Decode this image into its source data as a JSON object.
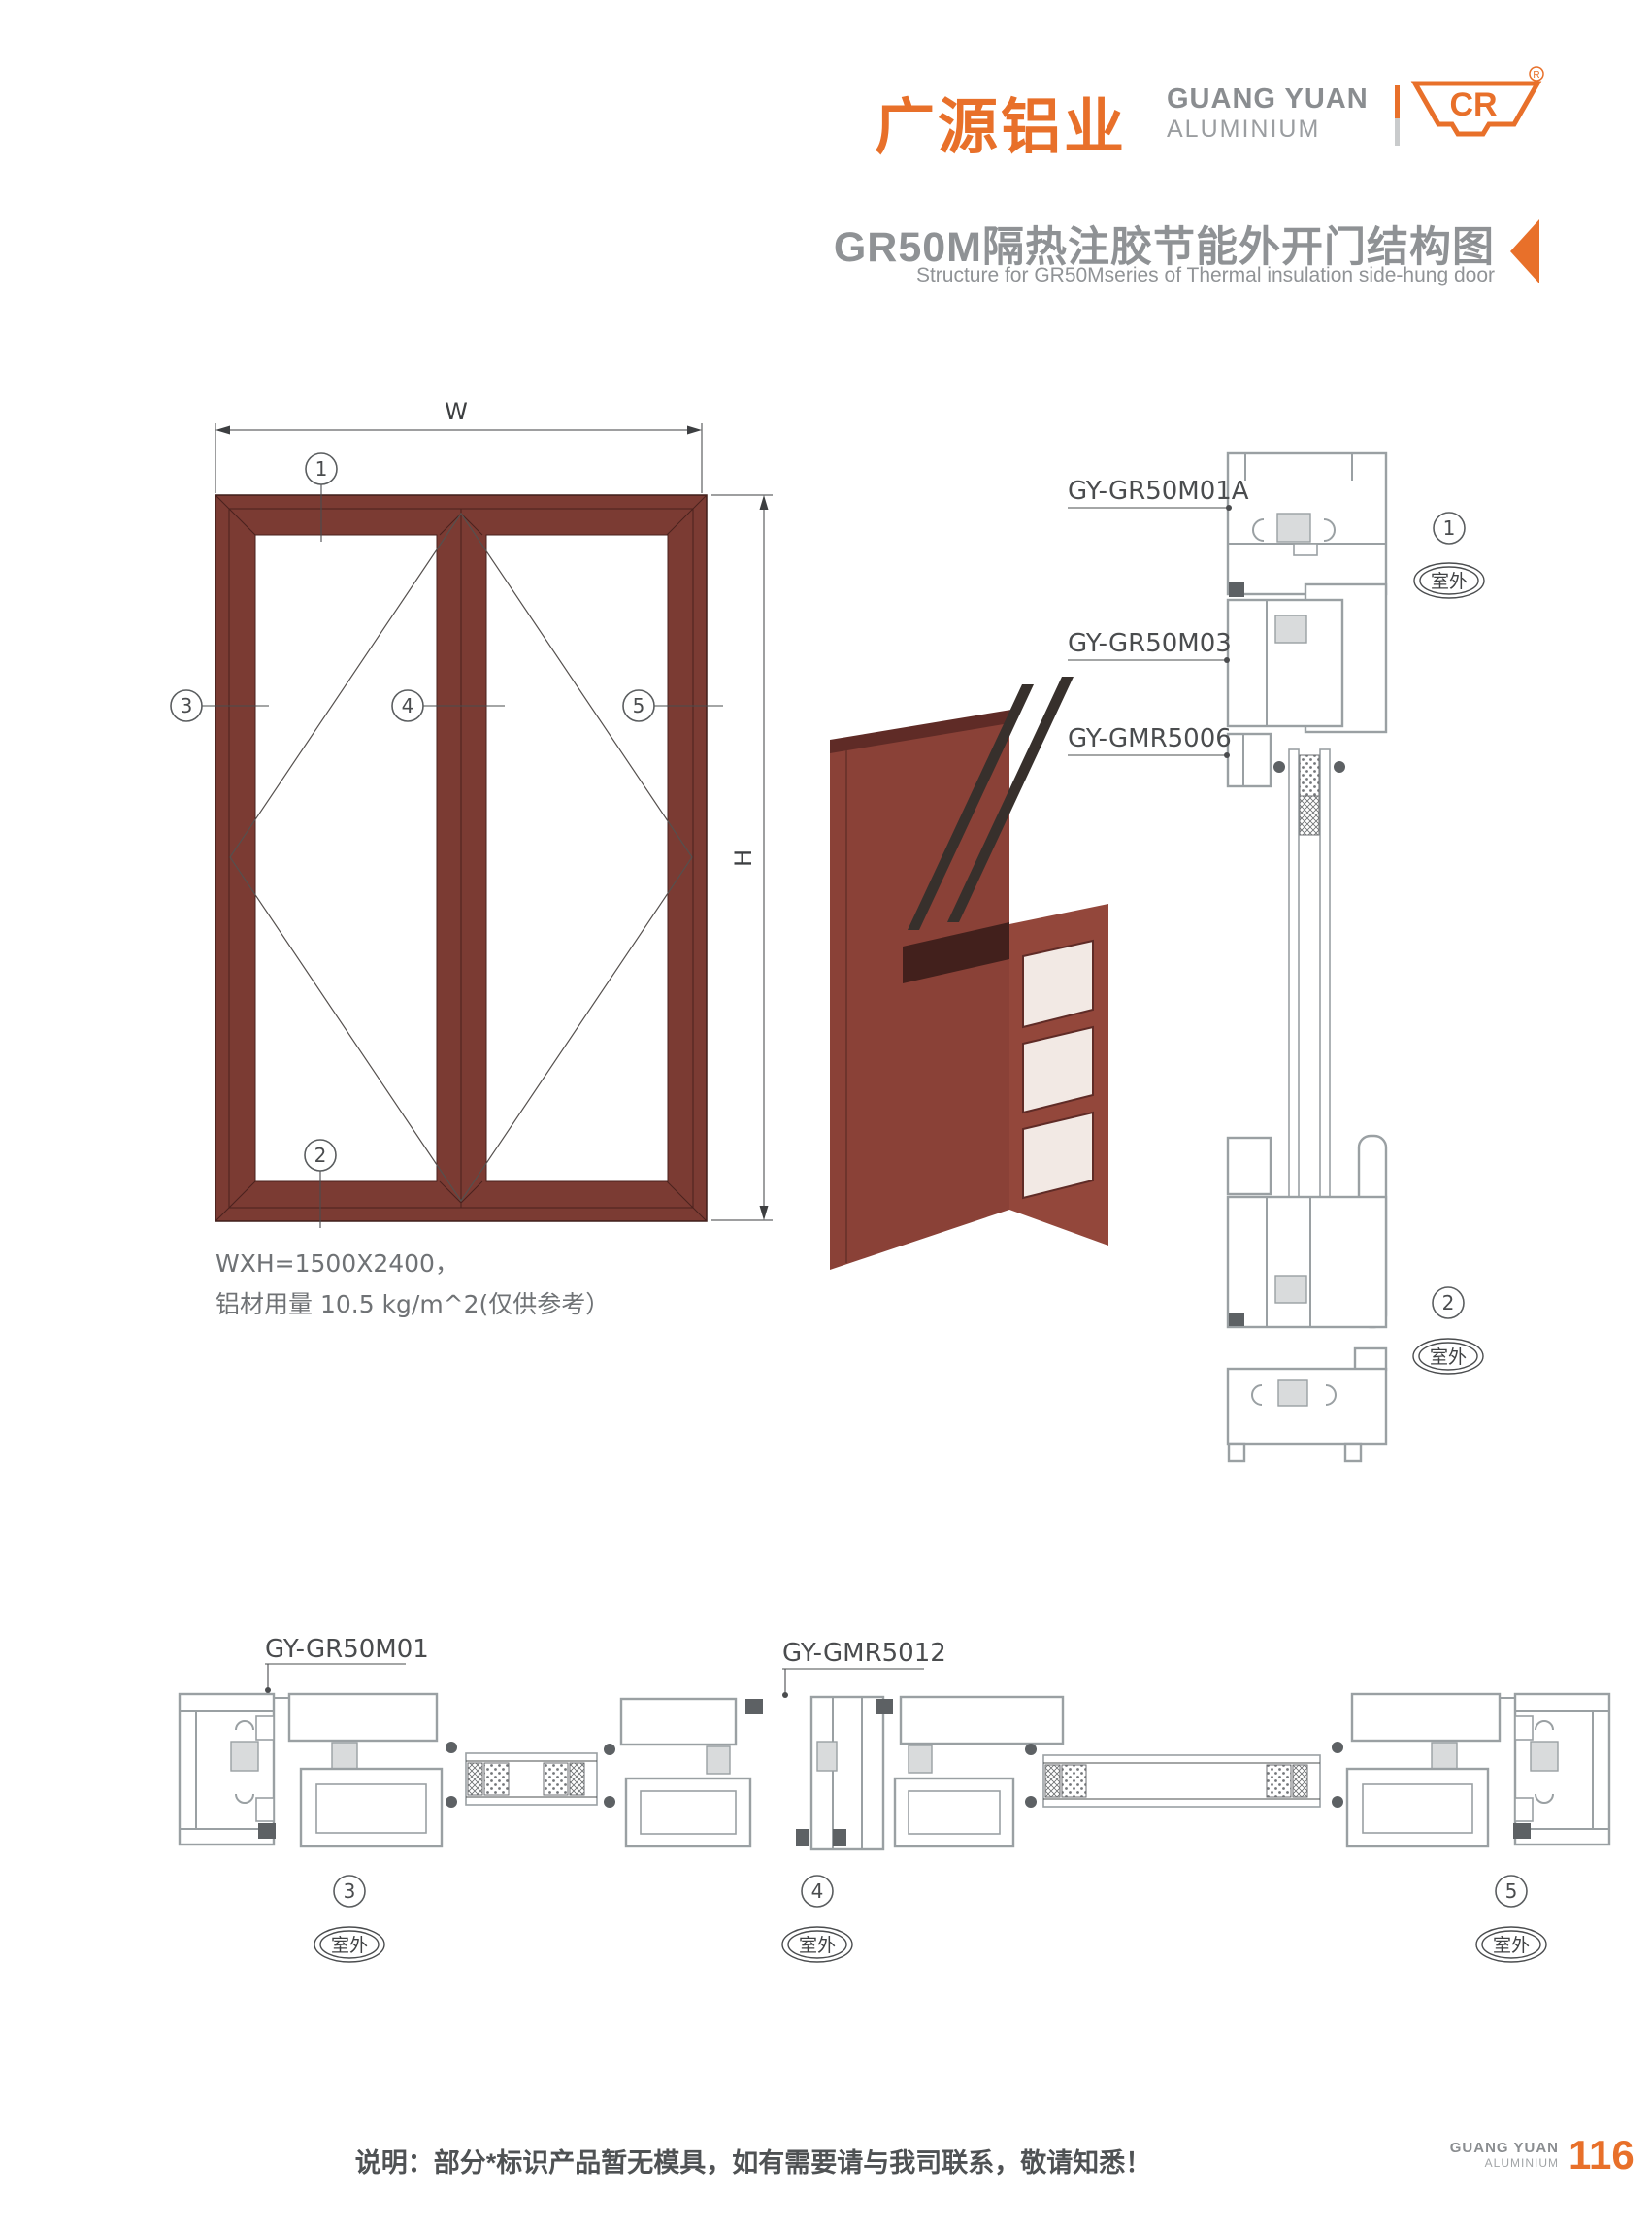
{
  "header": {
    "logo_cn": "广源铝业",
    "logo_en1": "GUANG YUAN",
    "logo_en2": "ALUMINIUM",
    "logo_mark": "CR",
    "reg": "®"
  },
  "title": {
    "cn": "GR50M隔热注胶节能外开门结构图",
    "en": "Structure for GR50Mseries of Thermal insulation side-hung door"
  },
  "elevation": {
    "dim_w": "W",
    "dim_h": "H",
    "callouts": [
      "1",
      "2",
      "3",
      "4",
      "5"
    ],
    "note1": "WXH=1500X2400，",
    "note2": "铝材用量 10.5 kg/m^2(仅供参考）"
  },
  "vsec": {
    "label_frame": "GY-GR50M01A",
    "label_sash": "GY-GR50M03",
    "label_bead": "GY-GMR5006",
    "callouts": [
      {
        "num": "1",
        "loc": "室外"
      },
      {
        "num": "2",
        "loc": "室外"
      }
    ]
  },
  "hsec": {
    "label_frame": "GY-GR50M01",
    "label_astragal": "GY-GMR5012",
    "callouts": [
      {
        "num": "3",
        "loc": "室外"
      },
      {
        "num": "4",
        "loc": "室外"
      },
      {
        "num": "5",
        "loc": "室外"
      }
    ]
  },
  "footer": {
    "note": "说明：部分*标识产品暂无模具，如有需要请与我司联系，敬请知悉！",
    "brand1": "GUANG YUAN",
    "brand2": "ALUMINIUM",
    "page": "116"
  },
  "colors": {
    "orange": "#E8702A",
    "title_gray": "#8F9295",
    "maroon": "#7B3B33",
    "line_gray": "#9AA0A3"
  }
}
